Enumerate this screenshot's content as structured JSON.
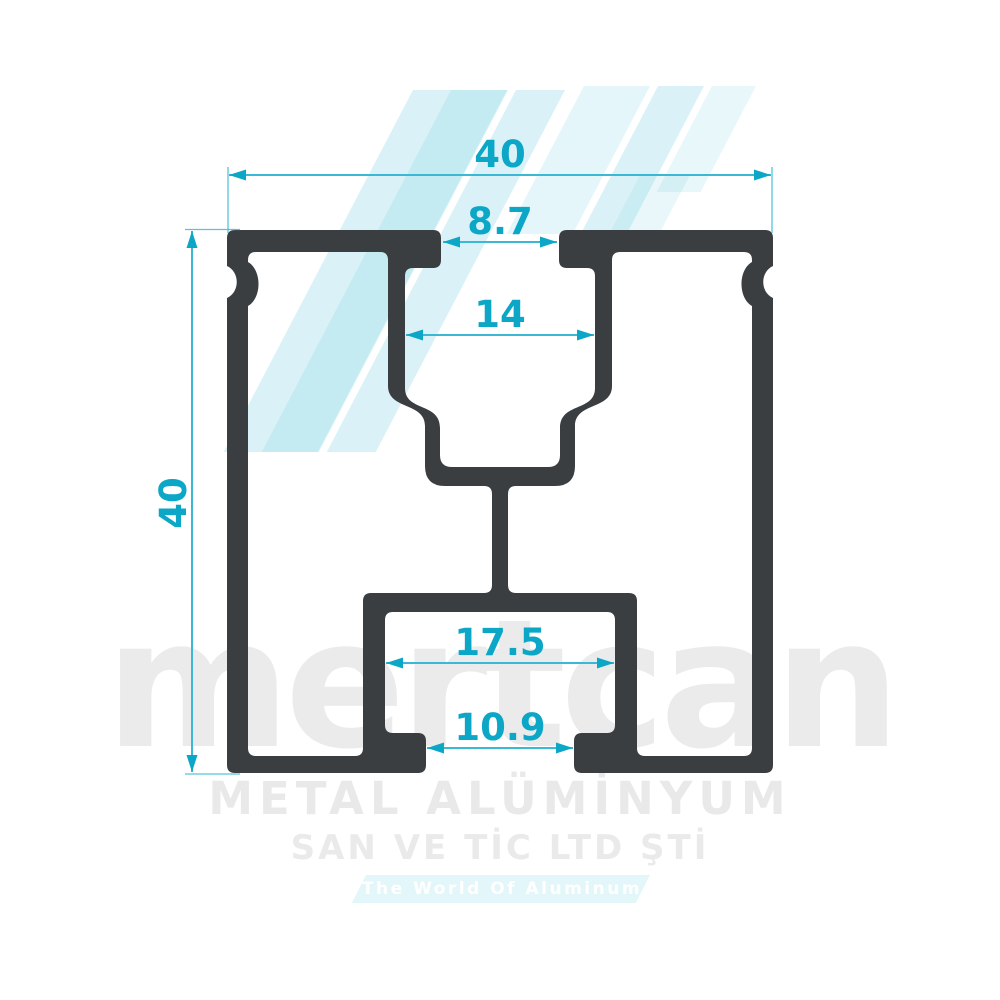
{
  "drawing": {
    "title_dimensions": {
      "overall_width": "40",
      "overall_height": "40",
      "slot_opening": "8.7",
      "slot_inner_width": "14",
      "box_inner_width": "17.5",
      "bottom_opening": "10.9"
    }
  },
  "watermark": {
    "brand": "mertcan",
    "line1": "METAL ALÜMİNYUM",
    "line2": "SAN VE TİC LTD ŞTİ",
    "banner": "The World Of Aluminum"
  },
  "colors": {
    "profile_fill": "#3b3e41",
    "dimension_line": "#3bb9d4",
    "dimension_text": "#0ca6c7",
    "watermark_gray": "#ebebeb",
    "banner_fill": "#e3f6fa",
    "stripe_cyan": "#d9f1f7",
    "background": "#ffffff"
  }
}
